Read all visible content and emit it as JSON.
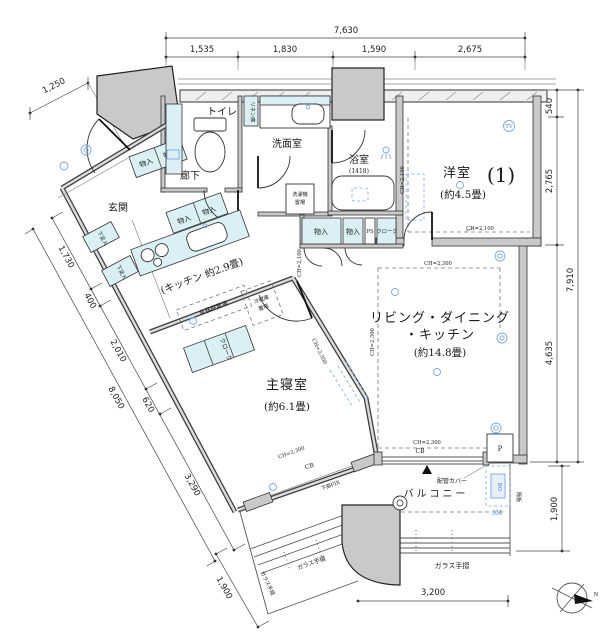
{
  "dims": {
    "top": {
      "total": "7,630",
      "seg1": "1,535",
      "seg2": "1,830",
      "seg3": "1,590",
      "seg4": "2,675"
    },
    "right": {
      "seg1": "540",
      "seg2": "2,765",
      "seg3": "4,635",
      "total": "7,910",
      "balcony": "1,900"
    },
    "left": {
      "top": "1,250",
      "seg1": "1,730",
      "seg2": "400",
      "seg3": "2,010",
      "seg4": "620",
      "seg5": "3,290",
      "total": "8,050",
      "balcony": "1,900"
    },
    "bottom": {
      "width": "3,200"
    }
  },
  "rooms": {
    "western": {
      "name": "洋室",
      "no": "(1)",
      "size": "(約4.5畳)"
    },
    "ldk": {
      "line1": "リビング・ダイニング",
      "line2": "・キッチン",
      "size": "(約14.8畳)"
    },
    "bedroom": {
      "name": "主寝室",
      "size": "(約6.1畳)"
    },
    "kitchen": "(キッチン 約2.9畳)",
    "entrance": "玄関",
    "hall": "廊下",
    "toilet": "トイレ",
    "washroom": "洗面室",
    "bath": "浴室",
    "bath_size": "(1418)",
    "balcony": "バルコニー"
  },
  "labels": {
    "monoire": "物入",
    "linen": "リネン庫",
    "shoe": "下足入",
    "cloak": "クローク",
    "ps": "PS",
    "washer1": "洗濯機",
    "washer2": "置場",
    "cupboard": "食器棚置場",
    "fridge1": "冷蔵庫",
    "fridge2": "置場",
    "glass_rail": "ガラス手摺",
    "pipe_cover": "配管カバー",
    "partition": "隔板",
    "under_fix": "下部FIX",
    "cb": "CB",
    "p": "P",
    "bo": "BO",
    "m3": "3M",
    "tv": "TV",
    "ch2100": "CH=2,100",
    "ch2300": "CH=2,300",
    "north": "N"
  }
}
